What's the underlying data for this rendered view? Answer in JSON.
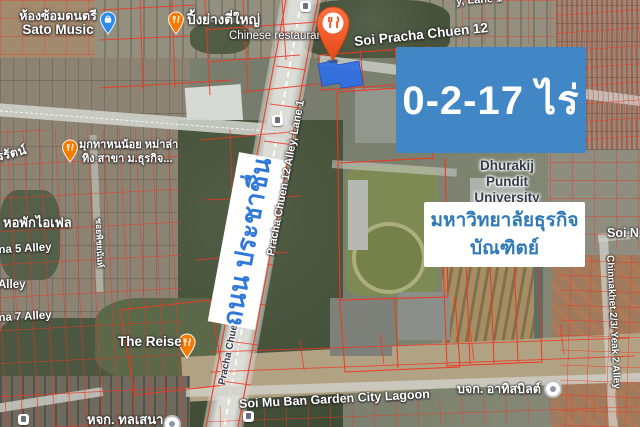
{
  "map": {
    "annotations": {
      "area_box": {
        "text": "0-2-17 ไร่",
        "bg": "#4187c6",
        "color": "#ffffff"
      },
      "university_box": {
        "line1": "มหาวิทยาลัยธุรกิจ",
        "line2": "บัณฑิตย์",
        "bg": "#ffffff",
        "color": "#3079b8"
      },
      "road_banner": {
        "text": "ถนน ประชาชื่น",
        "bg": "#ffffff",
        "color": "#3178d8"
      }
    },
    "pois": {
      "sato_music": {
        "line1": "ห้องซ้อมดนตรี",
        "line2": "Sato Music"
      },
      "grill": {
        "name": "ปิ้งย่างตี่ใหญ่",
        "category": "Chinese restaurant"
      },
      "mala": {
        "line1": "มุกทาหนน้อย หม่าล่า",
        "line2": "ทิง สาขา ม.ธุรกิจ..."
      },
      "the_reise": {
        "name": "The Reise"
      },
      "eiffel_dorm": {
        "name": "หอพักไอเฟล"
      },
      "athit": {
        "name": "บจก. อาทิสบิลต์"
      },
      "hjk": {
        "name": "หจก. ทลเสนา"
      },
      "university": {
        "line1": "Dhurakij",
        "line2": "Pundit",
        "line3": "University"
      }
    },
    "streets": {
      "soi_pracha_chuen_12": "Soi Pracha Chuen 12",
      "pracha_chuen_12_alley_lane_1": "Pracha Chuen 12 Alley, Lane 1",
      "pracha_chuen_road": "Pracha Chuen",
      "top_edge_partial": "y, Lane 1",
      "soi_n": "Soi N",
      "chinnakhet": "Chinnakhet 2/3/ Yeak 2 Alley",
      "phetcharat": "เพชรรัตน์",
      "soi_small": "ซอยพิชยนันท์",
      "lana5": "ana 5 Alley",
      "alley": "Alley",
      "lana7": "ana 7 Alley",
      "soi_mu_ban": "Soi Mu Ban Garden City Lagoon"
    },
    "colors": {
      "parcel_lines": "#ef3722",
      "plot_fill": "#2f6fe4",
      "pin_orange": "#f4511e",
      "pin_blue": "#2a8af0",
      "annotation_blue": "#4187c6",
      "road_gray": "#dcddd7"
    }
  }
}
